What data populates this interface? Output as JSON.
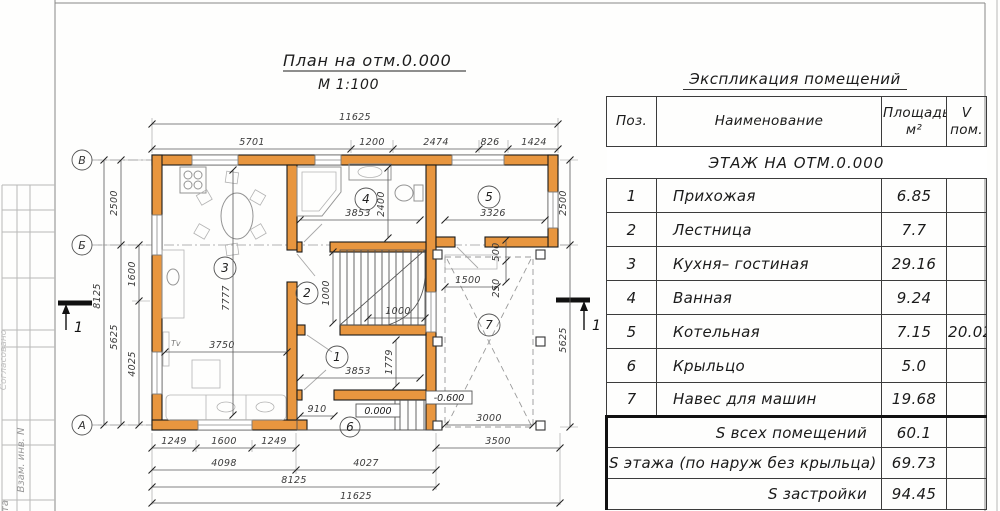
{
  "sheet": {
    "margin": {
      "soglasovano": "Согласовано",
      "vzam_inv": "Взам. инв. N",
      "data_cut": "та"
    }
  },
  "plan": {
    "title": "План на отм.0.000",
    "scale": "М 1:100",
    "axes": {
      "v": "В",
      "b": "Б",
      "a": "А",
      "section": "1"
    },
    "rooms": {
      "r1": "1",
      "r2": "2",
      "r3": "3",
      "r4": "4",
      "r5": "5",
      "r6": "6",
      "r7": "7"
    },
    "levels": {
      "zero": "0.000",
      "minus": "-0.600"
    },
    "tv": "Тv",
    "dims": {
      "overall_top": "11625",
      "t1": "5701",
      "t2": "1200",
      "t3": "2474",
      "t4": "826",
      "t5": "1424",
      "l_total": "8125",
      "l1": "2500",
      "l2": "5625",
      "l3": "1600",
      "l4": "4025",
      "rt1": "2500",
      "rt2": "5625",
      "b1": "1249",
      "b2": "1600",
      "b3": "1249",
      "b4": "3500",
      "b5": "4098",
      "b6": "4027",
      "b7": "8125",
      "b8": "11625",
      "room4_w": "3853",
      "room4_h": "2400",
      "room5_w": "3326",
      "room3_w": "3750",
      "room3_h": "7777",
      "stair_v": "1000",
      "stair_h": "1000",
      "room1_w": "3853",
      "room1_h": "1779",
      "door": "910",
      "cp1": "1500",
      "cp2": "500",
      "cp3": "250",
      "cp4": "3000",
      "cp5": "3500"
    }
  },
  "table": {
    "title": "Экспликация помещений",
    "headers": {
      "pos": "Поз.",
      "name": "Наименование",
      "area1": "Площадь",
      "area2": "м²",
      "vol1": "V",
      "vol2": "пом."
    },
    "section": "ЭТАЖ НА ОТМ.0.000",
    "rows": [
      {
        "pos": "1",
        "name": "Прихожая",
        "area": "6.85",
        "vol": ""
      },
      {
        "pos": "2",
        "name": "Лестница",
        "area": "7.7",
        "vol": ""
      },
      {
        "pos": "3",
        "name": "Кухня– гостиная",
        "area": "29.16",
        "vol": ""
      },
      {
        "pos": "4",
        "name": "Ванная",
        "area": "9.24",
        "vol": ""
      },
      {
        "pos": "5",
        "name": "Котельная",
        "area": "7.15",
        "vol": "20.02"
      },
      {
        "pos": "6",
        "name": "Крыльцо",
        "area": "5.0",
        "vol": ""
      },
      {
        "pos": "7",
        "name": "Навес для машин",
        "area": "19.68",
        "vol": ""
      }
    ],
    "summary": [
      {
        "label": "S всех помещений",
        "area": "60.1",
        "vol": ""
      },
      {
        "label": "S этажа (по наруж без крыльца)",
        "area": "69.73",
        "vol": ""
      },
      {
        "label": "S застройки",
        "area": "94.45",
        "vol": ""
      }
    ]
  }
}
